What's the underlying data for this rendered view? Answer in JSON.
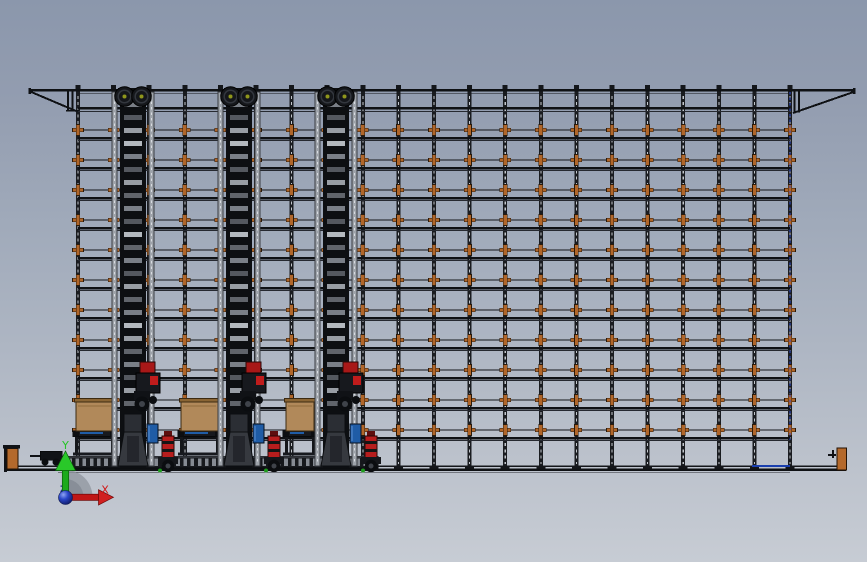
{
  "scene": {
    "canvas": {
      "width": 867,
      "height": 562
    },
    "background": {
      "top": "#8b97ac",
      "middle": "#a9b2c0",
      "bottom": "#c7ccd4"
    },
    "rack": {
      "left": 78,
      "right": 790,
      "top_chord_y": 90,
      "second_beam_y": 108,
      "column_count": 21,
      "column_spacing": 35.6,
      "shelf_row_count": 11,
      "row_start_y": 130,
      "row_step": 30,
      "floor_y": 466,
      "floor_left": 6,
      "floor_right": 846,
      "colors": {
        "structure": "#14161a",
        "beam": "#0f1114",
        "thin": "#262930",
        "column_core": "#c2c6cc",
        "light_column": "#9ea3aa",
        "connector": "#b0662a",
        "connector_outline": "#2a1a0a",
        "blue_dash": "#2b4bd6",
        "floor_blue": "#1a3fae"
      },
      "bracket_left_tip_x": 30,
      "bracket_right_tip_x": 855
    },
    "cranes": {
      "mast_centers": [
        133,
        239,
        336
      ],
      "mast_width": 26,
      "colors": {
        "mast": "#0d0f12",
        "rungs": [
          "#7a7f87",
          "#54585f",
          "#989da4",
          "#60646b"
        ],
        "rung_bright": "#b4b9bf",
        "pulley": "#15171b",
        "pulley_ring": "#33373e",
        "pulley_hub": "#8f961c",
        "carriage_red": "#a81818",
        "carriage_red2": "#c01c1c",
        "body": "#17191e",
        "base": "#36393f",
        "base_dark": "#24262c",
        "blue_box": "#1f5ca6",
        "motor_red": "#b71d1d",
        "motor_band": "#151515",
        "motor_cap": "#5e0e0e",
        "wheel": "#0b0d10",
        "hub": "#3f434a",
        "green_dot": "#1e9a1e"
      }
    },
    "pallet_stations": {
      "items": [
        {
          "x": 76,
          "w": 37
        },
        {
          "x": 181,
          "w": 37
        },
        {
          "x": 286,
          "w": 28
        }
      ],
      "box_y": 400,
      "box_h": 31,
      "colors": {
        "box": "#b1895a",
        "box_lip": "#8a6534",
        "box_edge": "#3c2a12",
        "platform": "#17191e",
        "blue": "#1f5ca6"
      }
    },
    "conveyor": {
      "x1": 58,
      "x2": 378,
      "y": 456.5,
      "h": 11.5,
      "tick": "#868b93",
      "body": "#17191d",
      "edge": "#4c5058"
    },
    "trolley": {
      "x": 40,
      "y": 451
    },
    "end_stops": {
      "left_x": 7,
      "right_x": 837,
      "color": "#b4692c",
      "outline": "#241204",
      "plate": "#101216"
    },
    "triad": {
      "labels": {
        "x": "X",
        "y": "Y",
        "z": "Z"
      },
      "colors": {
        "x": "#d01818",
        "y": "#24c424",
        "z": "#1c2e8a",
        "arc": "#8d939c",
        "sphere_dark": "#101c66"
      }
    }
  }
}
